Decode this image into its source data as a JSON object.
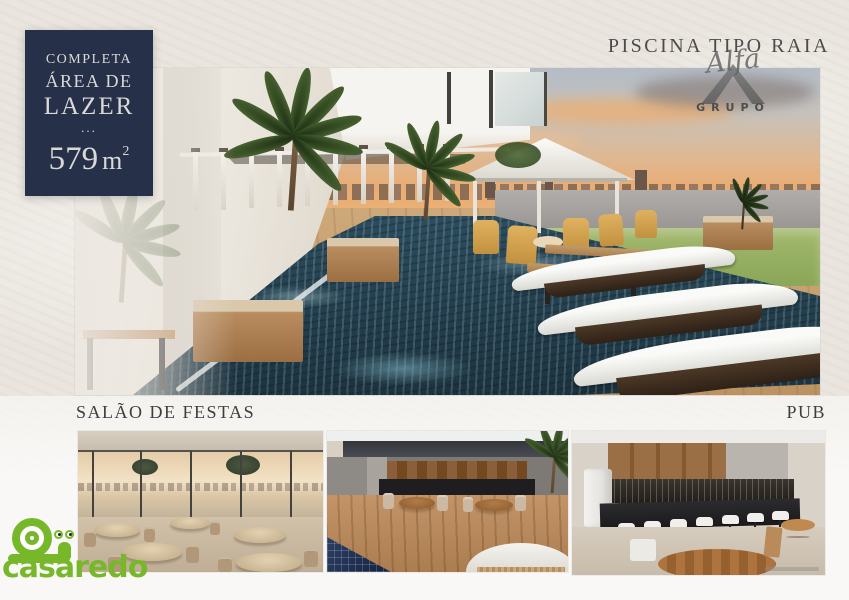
{
  "badge": {
    "line1": "COMPLETA",
    "line2": "ÁREA DE",
    "line3": "LAZER",
    "dots": "...",
    "area_value": "579",
    "area_unit": "m",
    "area_exponent": "2",
    "bg_color": "#273049"
  },
  "header": {
    "title": "PISCINA TIPO RAIA",
    "logo": {
      "script": "Alfa",
      "grupo": "GRUPO"
    }
  },
  "sections": {
    "left_label": "SALÃO DE FESTAS",
    "right_label": "PUB"
  },
  "watermark": {
    "brand": "casaredo",
    "color": "#76b82a",
    "icon": "snail-icon"
  },
  "images": {
    "main": "pool-lap-render",
    "thumb1": "party-hall-render",
    "thumb2": "terrace-render",
    "thumb3": "pub-bar-render"
  }
}
